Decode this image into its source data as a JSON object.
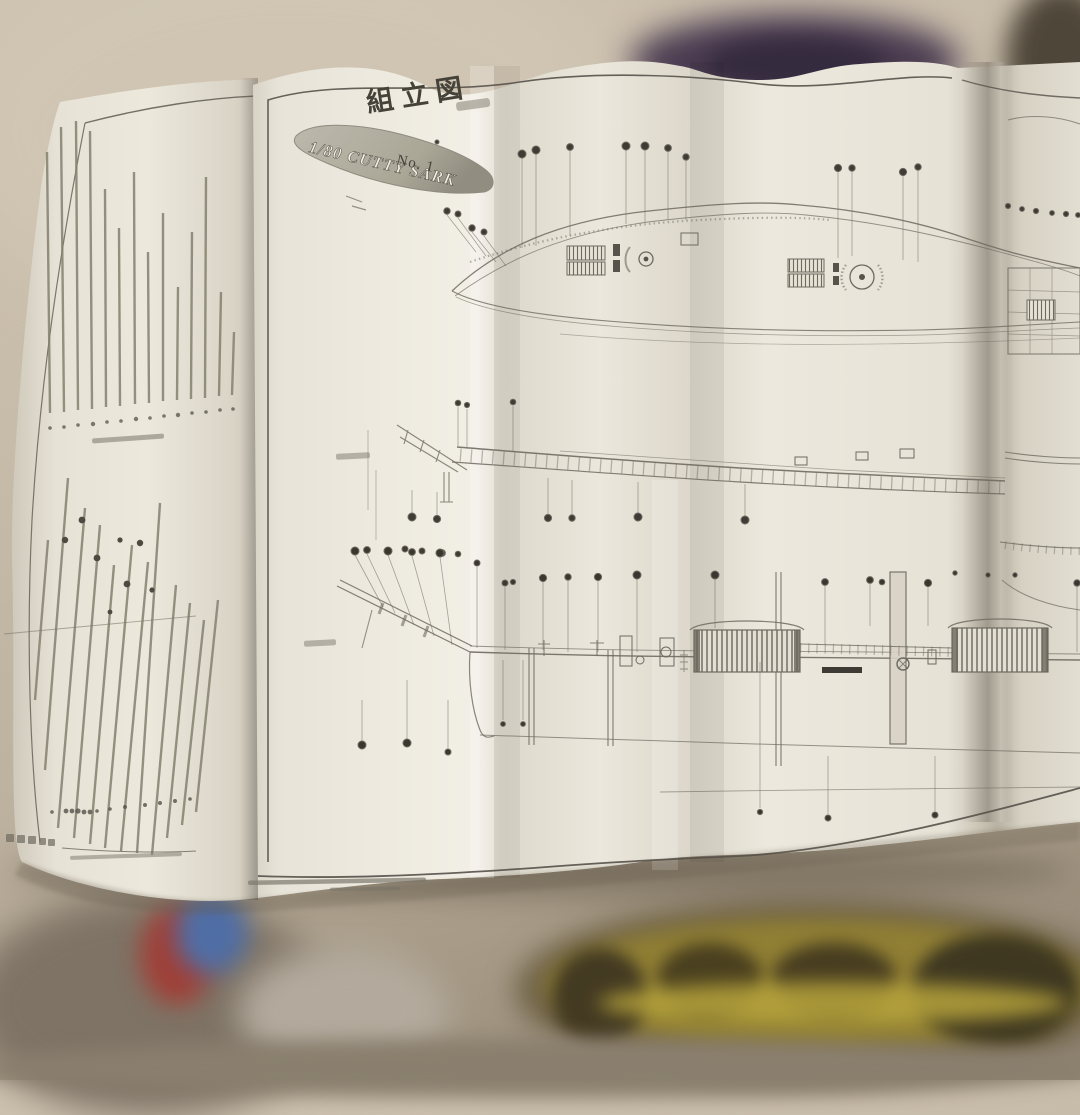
{
  "document": {
    "type_label": "組立図",
    "ribbon_label": "1/80 CUTTY SARK",
    "sheet_number": "No. 1"
  },
  "colors": {
    "paper": "#ebe7dc",
    "ink": "#5b574d",
    "ribbon_fill": "#b4b0a4",
    "background_wall": "#c7bba9",
    "shadow_purple": "#46384e",
    "blur_yellow": "#907f34",
    "blur_red": "#a04038",
    "blur_blue": "#4f6ea6"
  }
}
